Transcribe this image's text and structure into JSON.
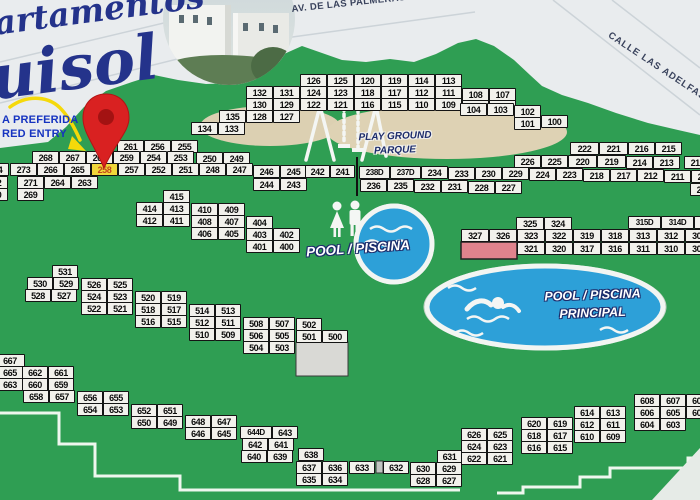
{
  "map": {
    "title_partial": [
      "artamentos",
      "uisol"
    ],
    "streets": {
      "top": "AV. DE LAS PALMERAS",
      "right": "CALLE LAS ADELFAS"
    },
    "entry_note": [
      "A PREFERIDA",
      "RED ENTRY"
    ],
    "playground_label": [
      "PLAY GROUND",
      "PARQUE"
    ],
    "small_pool_label": "POOL / PISCINA",
    "main_pool_label": [
      "POOL / PISCINA",
      "PRINCIPAL"
    ],
    "highlighted_unit": "258",
    "pin_target_unit": "260",
    "colors": {
      "grass": "#2f9e53",
      "street": "#e9ecee",
      "box_fill": "#f2f1ec",
      "box_border": "#141414",
      "highlight_bg": "#f0d73a",
      "highlight_text": "#c0471c",
      "pool_water": "#2da0d8",
      "sand": "#dcd0b2",
      "pin_red": "#d92121",
      "navy": "#24338b",
      "pink_building": "#e0838d"
    },
    "units": [
      [
        "126",
        300,
        74
      ],
      [
        "125",
        327,
        74
      ],
      [
        "120",
        354,
        74
      ],
      [
        "119",
        381,
        74
      ],
      [
        "114",
        408,
        74
      ],
      [
        "113",
        435,
        74
      ],
      [
        "132",
        246,
        86
      ],
      [
        "131",
        273,
        86
      ],
      [
        "124",
        300,
        86
      ],
      [
        "123",
        327,
        86
      ],
      [
        "118",
        354,
        86
      ],
      [
        "117",
        381,
        86
      ],
      [
        "112",
        408,
        86
      ],
      [
        "111",
        435,
        86
      ],
      [
        "108",
        462,
        88
      ],
      [
        "107",
        489,
        88
      ],
      [
        "130",
        246,
        98
      ],
      [
        "129",
        273,
        98
      ],
      [
        "122",
        300,
        98
      ],
      [
        "121",
        327,
        98
      ],
      [
        "116",
        354,
        98
      ],
      [
        "115",
        381,
        98
      ],
      [
        "110",
        408,
        98
      ],
      [
        "109",
        435,
        98
      ],
      [
        "106",
        462,
        100
      ],
      [
        "105",
        489,
        100
      ],
      [
        "104",
        460,
        103
      ],
      [
        "103",
        487,
        103
      ],
      [
        "102",
        514,
        105
      ],
      [
        "135",
        219,
        110
      ],
      [
        "128",
        246,
        110
      ],
      [
        "127",
        273,
        110
      ],
      [
        "101",
        514,
        117
      ],
      [
        "100",
        541,
        115
      ],
      [
        "134",
        191,
        122
      ],
      [
        "133",
        218,
        122
      ],
      [
        "261",
        117,
        140
      ],
      [
        "256",
        144,
        140
      ],
      [
        "255",
        171,
        140
      ],
      [
        "268",
        32,
        151
      ],
      [
        "267",
        59,
        151
      ],
      [
        "260",
        86,
        151
      ],
      [
        "259",
        113,
        151
      ],
      [
        "254",
        140,
        151
      ],
      [
        "253",
        167,
        151
      ],
      [
        "250",
        196,
        152
      ],
      [
        "249",
        223,
        152
      ],
      [
        "274",
        -18,
        163
      ],
      [
        "273",
        10,
        163
      ],
      [
        "266",
        37,
        163
      ],
      [
        "265",
        64,
        163
      ],
      [
        "258",
        91,
        163
      ],
      [
        "257",
        118,
        163
      ],
      [
        "252",
        145,
        163
      ],
      [
        "251",
        172,
        163
      ],
      [
        "248",
        199,
        163
      ],
      [
        "247",
        226,
        163
      ],
      [
        "246",
        253,
        165
      ],
      [
        "245",
        280,
        165
      ],
      [
        "272",
        -19,
        176
      ],
      [
        "271",
        17,
        176
      ],
      [
        "264",
        44,
        176
      ],
      [
        "263",
        71,
        176
      ],
      [
        "244",
        253,
        178
      ],
      [
        "243",
        280,
        178
      ],
      [
        "270",
        -19,
        188
      ],
      [
        "269",
        17,
        188
      ],
      [
        "242",
        305,
        165,
        25
      ],
      [
        "241",
        330,
        165,
        25
      ],
      [
        "238D",
        359,
        166,
        31
      ],
      [
        "237D",
        390,
        166,
        31
      ],
      [
        "234",
        421,
        166
      ],
      [
        "233",
        448,
        167
      ],
      [
        "230",
        475,
        167
      ],
      [
        "229",
        502,
        167
      ],
      [
        "224",
        529,
        168
      ],
      [
        "223",
        556,
        168
      ],
      [
        "218",
        583,
        169
      ],
      [
        "217",
        610,
        169
      ],
      [
        "212",
        637,
        169
      ],
      [
        "211",
        664,
        170
      ],
      [
        "208",
        691,
        170
      ],
      [
        "236",
        360,
        179
      ],
      [
        "235",
        387,
        179
      ],
      [
        "232",
        414,
        180
      ],
      [
        "231",
        441,
        180
      ],
      [
        "228",
        468,
        181
      ],
      [
        "227",
        495,
        181
      ],
      [
        "206",
        690,
        183
      ],
      [
        "222",
        570,
        142,
        29
      ],
      [
        "221",
        599,
        142,
        29
      ],
      [
        "216",
        628,
        142
      ],
      [
        "215",
        655,
        142
      ],
      [
        "226",
        514,
        155
      ],
      [
        "225",
        541,
        155
      ],
      [
        "220",
        568,
        155,
        29
      ],
      [
        "219",
        597,
        155,
        29
      ],
      [
        "214",
        626,
        156
      ],
      [
        "213",
        653,
        156
      ],
      [
        "210",
        684,
        156
      ],
      [
        "325",
        516,
        217,
        28
      ],
      [
        "324",
        544,
        217,
        28
      ],
      [
        "315D",
        628,
        216,
        33
      ],
      [
        "314D",
        661,
        216,
        33
      ],
      [
        "313D",
        694,
        216,
        33
      ],
      [
        "327",
        461,
        229,
        28
      ],
      [
        "326",
        489,
        229,
        28
      ],
      [
        "323",
        517,
        229,
        28
      ],
      [
        "322",
        545,
        229,
        28
      ],
      [
        "319",
        573,
        229,
        28
      ],
      [
        "318",
        601,
        229,
        28
      ],
      [
        "313",
        629,
        229,
        28
      ],
      [
        "312",
        657,
        229,
        28
      ],
      [
        "308",
        685,
        229,
        28
      ],
      [
        "321",
        517,
        242,
        28
      ],
      [
        "320",
        545,
        242,
        28
      ],
      [
        "317",
        573,
        242,
        28
      ],
      [
        "316",
        601,
        242,
        28
      ],
      [
        "311",
        629,
        242,
        28
      ],
      [
        "310",
        657,
        242,
        28
      ],
      [
        "307",
        685,
        242,
        28
      ],
      [
        "415",
        163,
        190
      ],
      [
        "414",
        136,
        202
      ],
      [
        "413",
        163,
        202
      ],
      [
        "410",
        191,
        203
      ],
      [
        "409",
        218,
        203
      ],
      [
        "412",
        136,
        214
      ],
      [
        "411",
        163,
        214
      ],
      [
        "408",
        191,
        215
      ],
      [
        "407",
        218,
        215
      ],
      [
        "404",
        246,
        216
      ],
      [
        "406",
        191,
        227
      ],
      [
        "405",
        218,
        227
      ],
      [
        "403",
        246,
        228
      ],
      [
        "402",
        273,
        228
      ],
      [
        "401",
        246,
        240
      ],
      [
        "400",
        273,
        240
      ],
      [
        "531",
        52,
        265,
        26
      ],
      [
        "530",
        27,
        277,
        26
      ],
      [
        "529",
        53,
        277,
        26
      ],
      [
        "526",
        81,
        278,
        26
      ],
      [
        "525",
        107,
        278,
        26
      ],
      [
        "528",
        25,
        289,
        26
      ],
      [
        "527",
        51,
        289,
        26
      ],
      [
        "524",
        81,
        290,
        26
      ],
      [
        "523",
        107,
        290,
        26
      ],
      [
        "520",
        135,
        291,
        26
      ],
      [
        "519",
        161,
        291,
        26
      ],
      [
        "522",
        81,
        302,
        26
      ],
      [
        "521",
        107,
        302,
        26
      ],
      [
        "518",
        135,
        303,
        26
      ],
      [
        "517",
        161,
        303,
        26
      ],
      [
        "514",
        189,
        304,
        26
      ],
      [
        "513",
        215,
        304,
        26
      ],
      [
        "516",
        135,
        315,
        26
      ],
      [
        "515",
        161,
        315,
        26
      ],
      [
        "512",
        189,
        316,
        26
      ],
      [
        "511",
        215,
        316,
        26
      ],
      [
        "508",
        243,
        317,
        26
      ],
      [
        "507",
        269,
        317,
        26
      ],
      [
        "502",
        296,
        318,
        26
      ],
      [
        "510",
        189,
        328,
        26
      ],
      [
        "509",
        215,
        328,
        26
      ],
      [
        "506",
        243,
        329,
        26
      ],
      [
        "505",
        269,
        329,
        26
      ],
      [
        "501",
        296,
        330,
        26
      ],
      [
        "500",
        322,
        330,
        26
      ],
      [
        "504",
        243,
        341,
        26
      ],
      [
        "503",
        269,
        341,
        26
      ],
      [
        "667",
        -5,
        354,
        30
      ],
      [
        "665",
        -5,
        366,
        30
      ],
      [
        "662",
        22,
        366,
        26
      ],
      [
        "661",
        48,
        366,
        26
      ],
      [
        "663",
        -5,
        378,
        30
      ],
      [
        "660",
        22,
        378,
        26
      ],
      [
        "659",
        48,
        378,
        26
      ],
      [
        "658",
        23,
        390,
        26
      ],
      [
        "657",
        49,
        390,
        26
      ],
      [
        "656",
        77,
        391,
        26
      ],
      [
        "655",
        103,
        391,
        26
      ],
      [
        "654",
        77,
        403,
        26
      ],
      [
        "653",
        103,
        403,
        26
      ],
      [
        "652",
        131,
        404,
        26
      ],
      [
        "651",
        157,
        404,
        26
      ],
      [
        "650",
        131,
        416,
        26
      ],
      [
        "649",
        157,
        416,
        26
      ],
      [
        "648",
        185,
        415,
        26
      ],
      [
        "647",
        211,
        415,
        26
      ],
      [
        "646",
        185,
        427,
        26
      ],
      [
        "645",
        211,
        427,
        26
      ],
      [
        "644D",
        240,
        426,
        32
      ],
      [
        "643",
        272,
        426,
        26
      ],
      [
        "642",
        242,
        438,
        26
      ],
      [
        "641",
        268,
        438,
        26
      ],
      [
        "640",
        241,
        450,
        26
      ],
      [
        "639",
        267,
        450,
        26
      ],
      [
        "638",
        298,
        448,
        26
      ],
      [
        "637",
        296,
        461,
        26
      ],
      [
        "636",
        322,
        461,
        26
      ],
      [
        "633",
        349,
        461,
        26
      ],
      [
        "632",
        383,
        461,
        26
      ],
      [
        "630",
        410,
        462,
        26
      ],
      [
        "629",
        436,
        462,
        26
      ],
      [
        "631",
        437,
        450,
        25
      ],
      [
        "635",
        296,
        473,
        26
      ],
      [
        "634",
        322,
        473,
        26
      ],
      [
        "628",
        410,
        474,
        26
      ],
      [
        "627",
        436,
        474,
        26
      ],
      [
        "608",
        634,
        394,
        26
      ],
      [
        "607",
        660,
        394,
        26
      ],
      [
        "602",
        686,
        394,
        26
      ],
      [
        "614",
        574,
        406,
        26
      ],
      [
        "613",
        600,
        406,
        26
      ],
      [
        "606",
        634,
        406,
        26
      ],
      [
        "605",
        660,
        406,
        26
      ],
      [
        "600",
        686,
        406,
        26
      ],
      [
        "620",
        521,
        417,
        26
      ],
      [
        "619",
        547,
        417,
        26
      ],
      [
        "612",
        574,
        418,
        26
      ],
      [
        "611",
        600,
        418,
        26
      ],
      [
        "604",
        634,
        418,
        26
      ],
      [
        "603",
        660,
        418,
        26
      ],
      [
        "626",
        461,
        428,
        26
      ],
      [
        "625",
        487,
        428,
        26
      ],
      [
        "618",
        521,
        429,
        26
      ],
      [
        "617",
        547,
        429,
        26
      ],
      [
        "610",
        574,
        430,
        26
      ],
      [
        "609",
        600,
        430,
        26
      ],
      [
        "624",
        461,
        440,
        26
      ],
      [
        "623",
        487,
        440,
        26
      ],
      [
        "616",
        521,
        441,
        26
      ],
      [
        "615",
        547,
        441,
        26
      ],
      [
        "622",
        461,
        452,
        26
      ],
      [
        "621",
        487,
        452,
        26
      ]
    ]
  }
}
